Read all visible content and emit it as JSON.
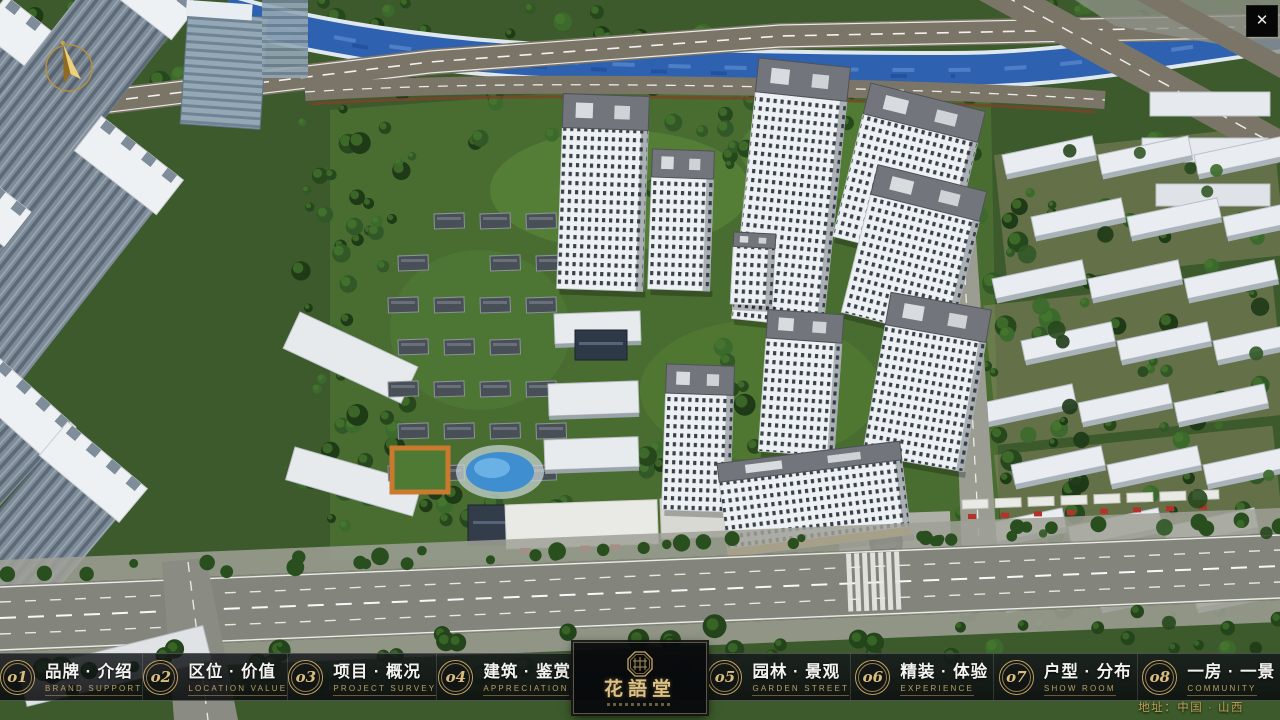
{
  "window": {
    "close_label": "✕"
  },
  "nav": {
    "items": [
      {
        "num": "o1",
        "zh": "品牌 · 介绍",
        "en": "BRAND SUPPORT"
      },
      {
        "num": "o2",
        "zh": "区位 · 价值",
        "en": "LOCATION VALUE"
      },
      {
        "num": "o3",
        "zh": "项目 · 概况",
        "en": "PROJECT SURVEY"
      },
      {
        "num": "o4",
        "zh": "建筑 · 鉴赏",
        "en": "APPRECIATION"
      },
      {
        "num": "o5",
        "zh": "园林 · 景观",
        "en": "GARDEN STREET"
      },
      {
        "num": "o6",
        "zh": "精装 · 体验",
        "en": "EXPERIENCE"
      },
      {
        "num": "o7",
        "zh": "户型 · 分布",
        "en": "SHOW ROOM"
      },
      {
        "num": "o8",
        "zh": "一房 · 一景",
        "en": "COMMUNITY"
      }
    ]
  },
  "logo": {
    "title": "花語堂"
  },
  "footer": {
    "address": "地址：中国 · 山西"
  },
  "colors": {
    "gold": "#c2a264",
    "bar_bg": "#101316",
    "river": "#2e62b0"
  }
}
